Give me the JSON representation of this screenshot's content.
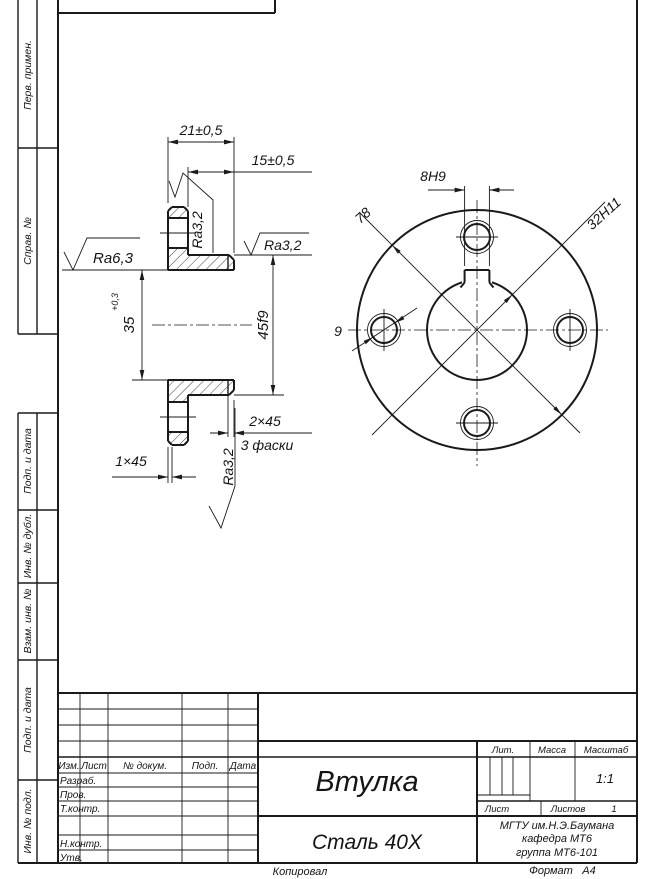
{
  "sidebar": {
    "items": [
      {
        "label": "Перв. примен."
      },
      {
        "label": "Справ. №"
      },
      {
        "label": "Подп. и дата"
      },
      {
        "label": "Инв. № дубл."
      },
      {
        "label": "Взам. инв. №"
      },
      {
        "label": "Подп. и дата"
      },
      {
        "label": "Инв. № подл."
      }
    ]
  },
  "drawing": {
    "section_view": {
      "width_total": "21±0,5",
      "hub_length": "15±0,5",
      "bore_diameter": "35",
      "bore_tolerance": "+0,3",
      "hub_diameter": "45f9",
      "chamfer_right": "2×45",
      "chamfer_note": "3 фаски",
      "chamfer_left": "1×45",
      "roughness_left": "Ra6,3",
      "roughness_keyway": "Ra3,2",
      "roughness_hub": "Ra3,2",
      "roughness_bore": "Ra3,2"
    },
    "front_view": {
      "keyway_width": "8H9",
      "outer_diameter": "78",
      "bore_diameter": "32H11",
      "hole_diameter": "9"
    }
  },
  "title_block": {
    "part_name": "Втулка",
    "material": "Сталь 40Х",
    "lit_label": "Лит.",
    "mass_label": "Масса",
    "scale_label": "Масштаб",
    "scale_value": "1:1",
    "sheet_label": "Лист",
    "sheets_label": "Листов",
    "sheets_value": "1",
    "org": [
      "МГТУ им.Н.Э.Баумана",
      "кафедра МТ6",
      "группа МТ6-101"
    ],
    "header_cols": [
      "Изм.",
      "Лист",
      "№ докум.",
      "Подп.",
      "Дата"
    ],
    "rows": [
      "Разраб.",
      "Пров.",
      "Т.контр.",
      "Н.контр.",
      "Утв."
    ],
    "copied_label": "Копировал",
    "format_label": "Формат",
    "format_value": "А4"
  }
}
